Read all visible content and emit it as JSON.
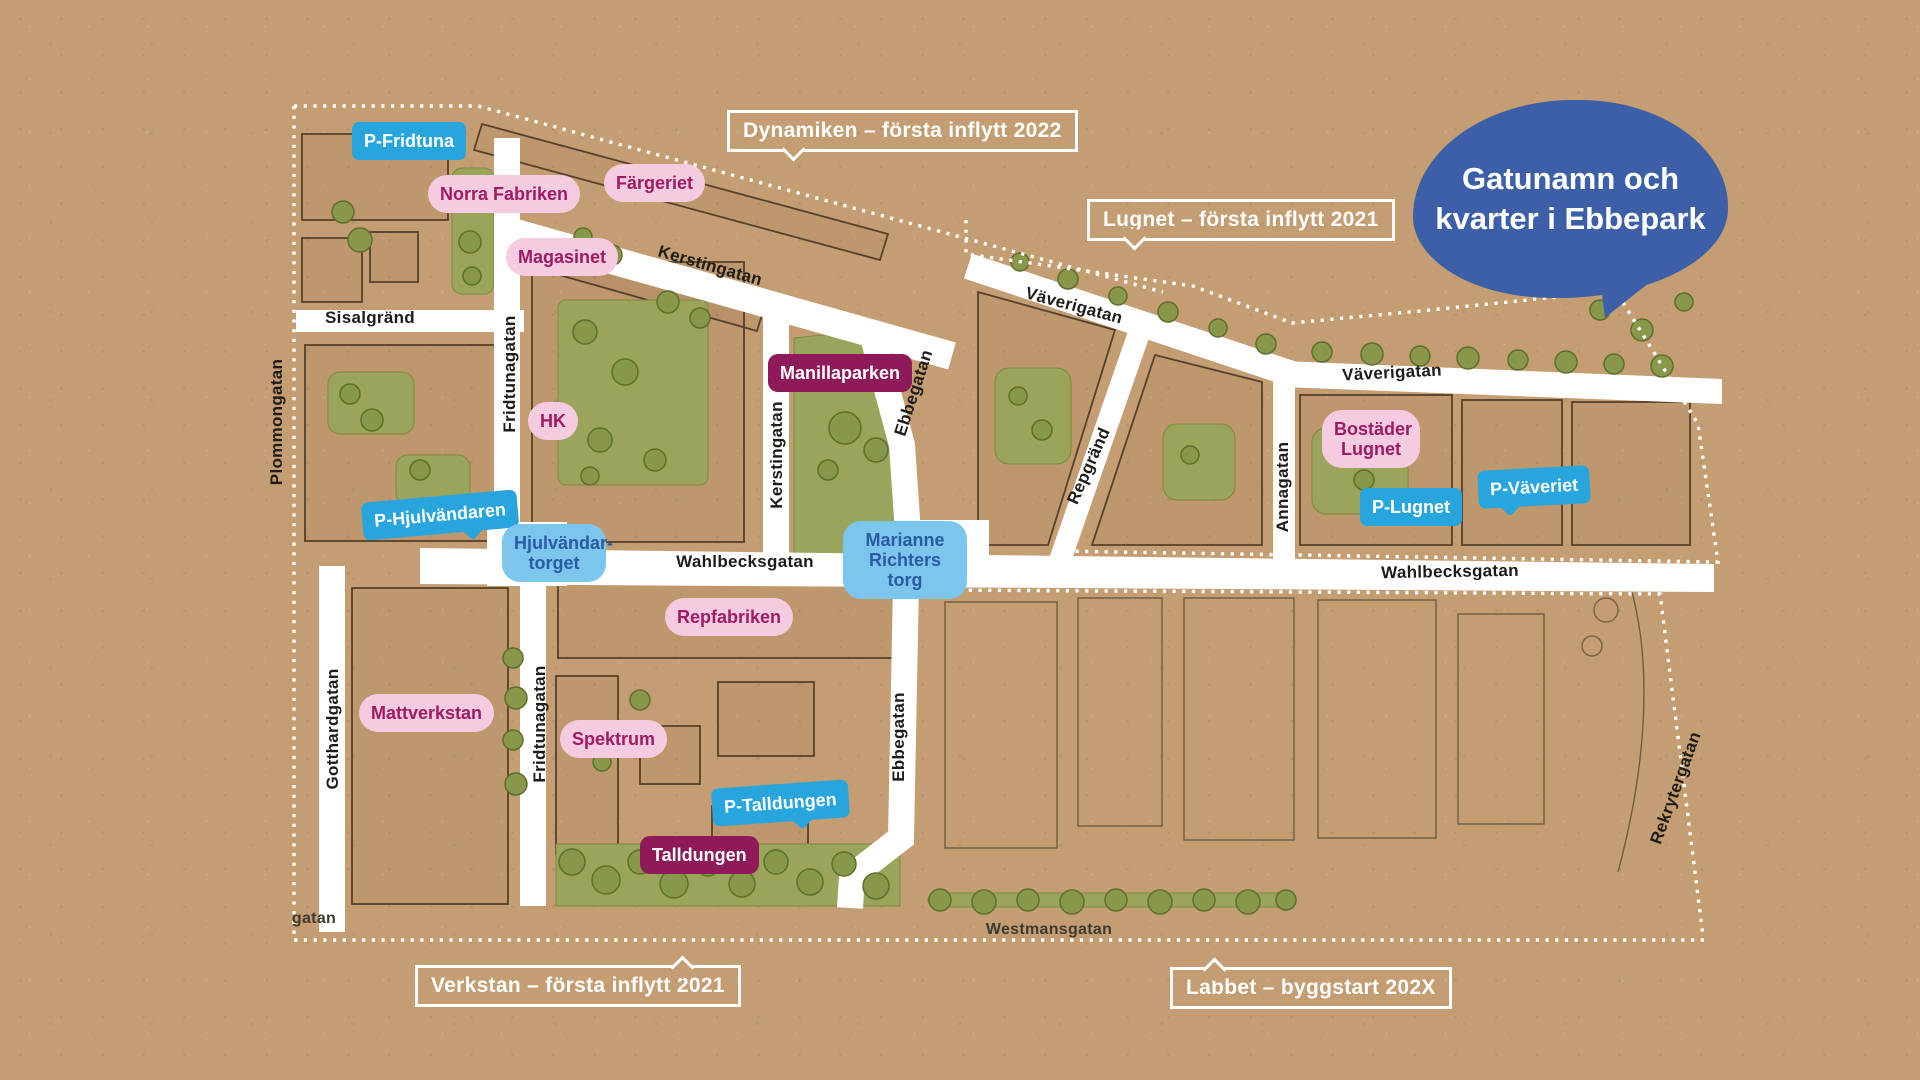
{
  "title": {
    "line1": "Gatunamn och",
    "line2": "kvarter i Ebbepark"
  },
  "areas": [
    {
      "id": "dynamiken",
      "label": "Dynamiken – första inflytt 2022"
    },
    {
      "id": "lugnet",
      "label": "Lugnet – första inflytt 2021"
    },
    {
      "id": "verkstan",
      "label": "Verkstan – första inflytt 2021"
    },
    {
      "id": "labbet",
      "label": "Labbet – byggstart 202X"
    }
  ],
  "bubbles": [
    {
      "label": "P-Fridtuna",
      "type": "parking"
    },
    {
      "label": "Norra Fabriken",
      "type": "building"
    },
    {
      "label": "Färgeriet",
      "type": "building"
    },
    {
      "label": "Magasinet",
      "type": "building"
    },
    {
      "label": "HK",
      "type": "building"
    },
    {
      "label": "Manillaparken",
      "type": "park"
    },
    {
      "label": "Bostäder Lugnet",
      "type": "building"
    },
    {
      "label": "P-Lugnet",
      "type": "parking"
    },
    {
      "label": "P-Väveriet",
      "type": "parking"
    },
    {
      "label": "P-Hjulvändaren",
      "type": "parking"
    },
    {
      "label": "Hjulvändar-torget",
      "type": "square"
    },
    {
      "label": "Marianne Richters torg",
      "type": "square"
    },
    {
      "label": "Mattverkstan",
      "type": "building"
    },
    {
      "label": "Repfabriken",
      "type": "building"
    },
    {
      "label": "Spektrum",
      "type": "building"
    },
    {
      "label": "P-Talldungen",
      "type": "parking"
    },
    {
      "label": "Talldungen",
      "type": "park"
    }
  ],
  "streets": [
    {
      "name": "Sisalgränd"
    },
    {
      "name": "Plommongatan"
    },
    {
      "name": "Fridtunagatan"
    },
    {
      "name": "Fridtunagatan"
    },
    {
      "name": "Gotthardgatan"
    },
    {
      "name": "Kerstingatan"
    },
    {
      "name": "Kerstingatan"
    },
    {
      "name": "Ebbegatan"
    },
    {
      "name": "Ebbegatan"
    },
    {
      "name": "Väverigatan"
    },
    {
      "name": "Väverigatan"
    },
    {
      "name": "Repgränd"
    },
    {
      "name": "Annagatan"
    },
    {
      "name": "Wahlbecksgatan"
    },
    {
      "name": "Wahlbecksgatan"
    },
    {
      "name": "Westmansgatan"
    },
    {
      "name": "Rekrytergatan"
    },
    {
      "name": "gatan"
    }
  ],
  "colors": {
    "paper": "#c49e72",
    "street_white": "#ffffff",
    "title_blue": "#3c5fa8",
    "bubble_pink_bg": "#f5cbdf",
    "bubble_pink_text": "#a01a64",
    "bubble_blue_bg": "#29a5de",
    "bubble_lightblue_bg": "#7cc5ec",
    "bubble_lightblue_text": "#2a5aa6",
    "bubble_plum_bg": "#8e1a59",
    "green": "#9aa45b",
    "area_outline": "#ffffff"
  }
}
